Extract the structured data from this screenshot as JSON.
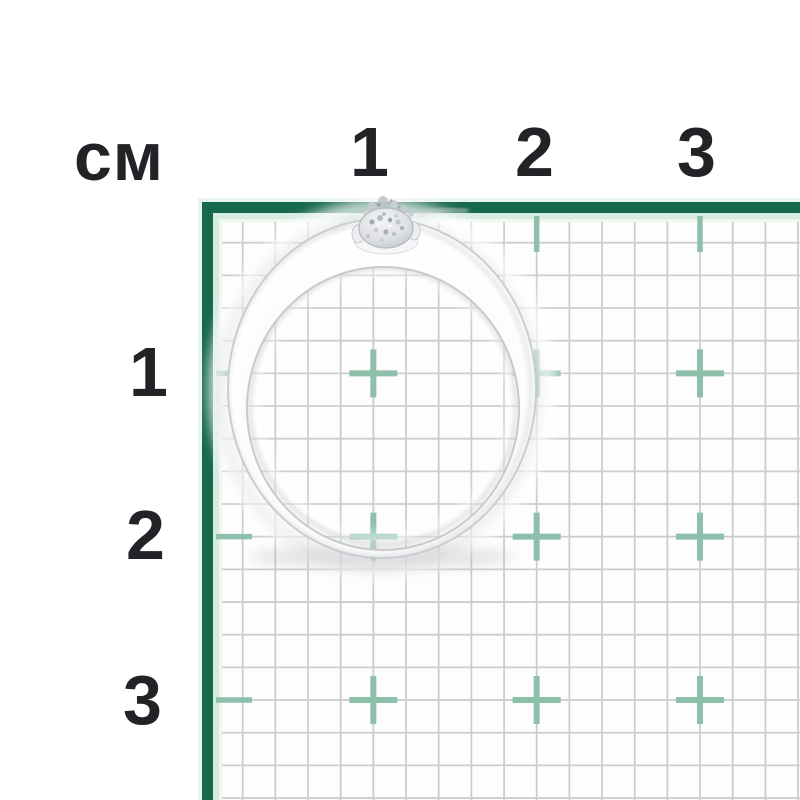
{
  "meta": {
    "type_description": "Product photo of a silver ring with a small round gemstone lying on a centimeter measurement grid"
  },
  "ruler": {
    "unit_label": "см",
    "top_numbers": [
      "1",
      "2",
      "3"
    ],
    "left_numbers": [
      "1",
      "2",
      "3"
    ]
  },
  "grid": {
    "origin_px": 210,
    "minor_step_px": 32.67,
    "cm_step_px": 163.33,
    "extent_px": 800,
    "cm_count": 3,
    "minor_stroke_px": 1.8,
    "cross_half_px": 24,
    "cross_stroke_px": 6,
    "tick_from_px": 216,
    "tick_to_px": 252,
    "tick_stroke_px": 5.5,
    "colors": {
      "border_green": "#17694d",
      "border_mint_outer": "#e9f5ef",
      "border_mint_inner": "#d5ecdf",
      "border_mint_fade": "#eef7f2",
      "minor_line": "#cbcdd0",
      "cross_teal": "#8cc0ab",
      "grid_bg": "#fdfdfe",
      "number_text": "#232327",
      "page_bg": "#ffffff"
    }
  },
  "ring": {
    "label": "silver-ring-with-stone",
    "approx_outer_width_cm": "1.9",
    "approx_outer_height_cm": "2.1",
    "band_color": "#f2f3f4",
    "stone_color": "#d9dce0"
  }
}
